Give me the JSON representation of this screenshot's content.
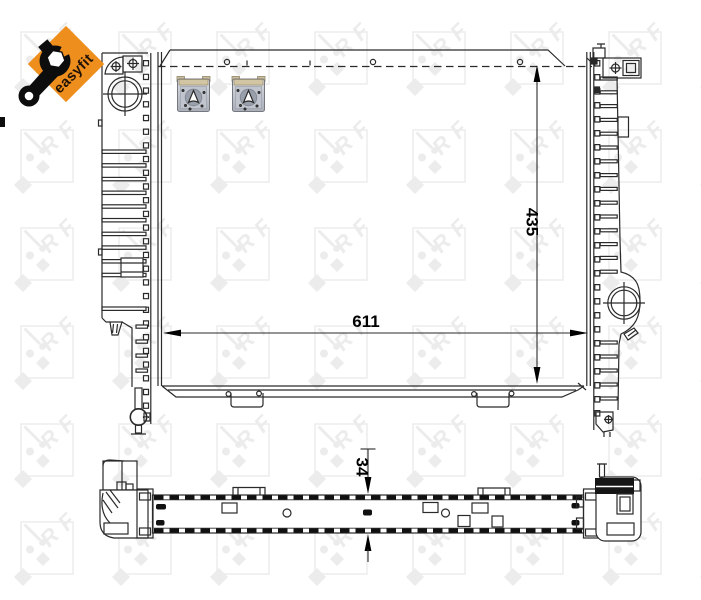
{
  "badge": {
    "label": "easyfit",
    "diamond_color": "#EE8E1D",
    "label_color": "#201206",
    "wrench_color": "#0D0D0D"
  },
  "watermark": {
    "brand": "NRF",
    "letters": [
      "N",
      "R",
      "F"
    ],
    "color": "#ECECEC"
  },
  "dimensions": {
    "core_height": "435",
    "core_width": "611",
    "depth": "34"
  },
  "drawing": {
    "line_color": "#2A2A2A",
    "hatch_color": "#111111"
  },
  "clips": {
    "body_color": "#BCC1CA",
    "tab_color": "#D2C5A4",
    "hole_color": "#99A0AC"
  }
}
